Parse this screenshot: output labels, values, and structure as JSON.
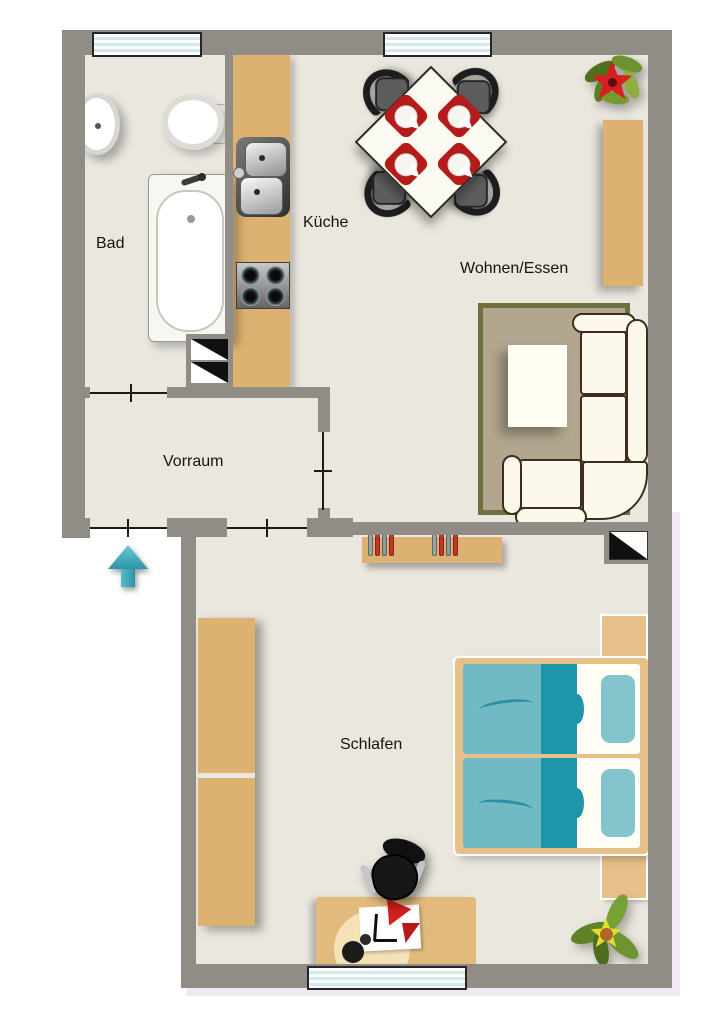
{
  "rooms": {
    "bad": {
      "label": "Bad"
    },
    "kueche": {
      "label": "Küche"
    },
    "wohnen_essen": {
      "label": "Wohnen/Essen"
    },
    "vorraum": {
      "label": "Vorraum"
    },
    "schlafen": {
      "label": "Schlafen"
    }
  },
  "colors": {
    "wall": "#8f8d85",
    "floor": "#eae7df",
    "wood": "#ddb271",
    "woodlight": "#e7c189",
    "rug": "#b2a68e",
    "rugborder": "#6e7040",
    "sofa": "#fcf9ec",
    "sofaborder": "#3e2d1c",
    "red": "#b61b1b",
    "teal": "#71bac3",
    "tealdark": "#1d96aa",
    "pillow": "#84c4cc",
    "arrow": "#36a5b8",
    "glass": "#d5e9ec",
    "trim": "#f1eaf2"
  }
}
